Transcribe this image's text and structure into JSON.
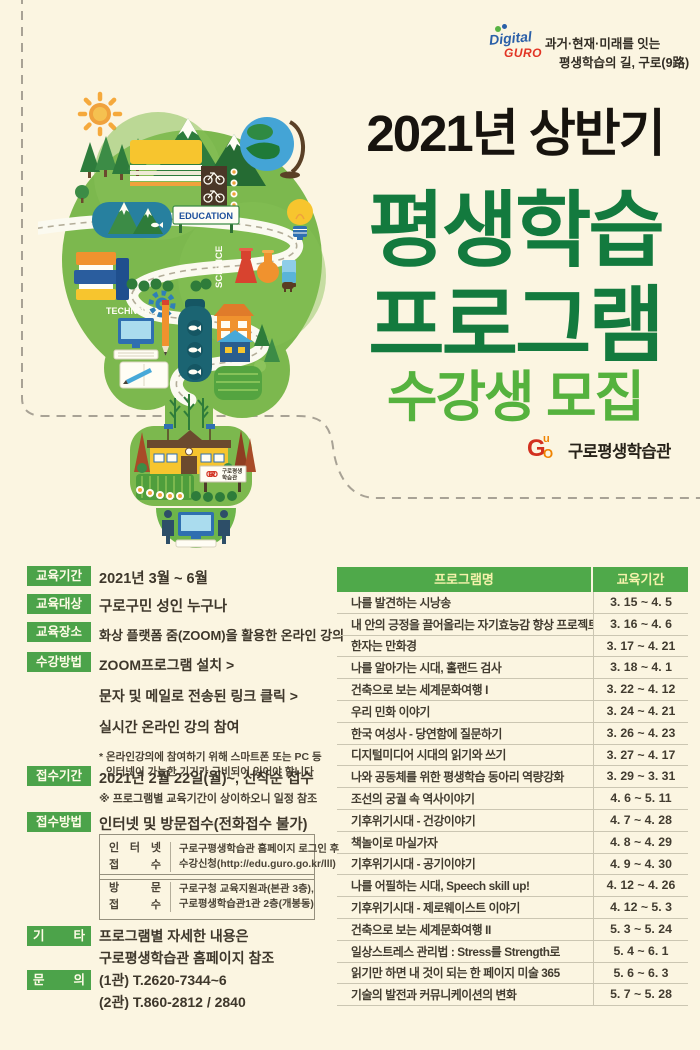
{
  "colors": {
    "background": "#fbf5e1",
    "title_dark_green": "#137a3e",
    "title_light_green": "#55b23e",
    "title_black": "#17130e",
    "label_green": "#4ca34a",
    "table_header_green": "#4fa94a",
    "table_header_text": "#f6f2ac",
    "logo_red": "#d2301f",
    "logo_orange": "#f08300"
  },
  "header": {
    "logo_digital": "Digital",
    "logo_guro": "GURO",
    "tagline_line1": "과거·현재·미래를 잇는",
    "tagline_line2": "평생학습의 길, 구로(9路)"
  },
  "title": {
    "line1": "2021년 상반기",
    "line2": "평생학습",
    "line3": "프로그램",
    "line4": "수강생 모집"
  },
  "org": {
    "mark_g": "G",
    "mark_u": "u",
    "mark_o": "O",
    "name": "구로평생학습관"
  },
  "illustration": {
    "badge_education": "EDUCATION",
    "badge_science": "SCIENCE",
    "badge_technology": "TECHNOLOGY",
    "sign_line1": "구로평생",
    "sign_line2": "학습관",
    "sign_logo": "GURO"
  },
  "sections": {
    "edu_period": {
      "label": "교육기간",
      "value": "2021년 3월 ~ 6월"
    },
    "edu_target": {
      "label": "교육대상",
      "value": "구로구민 성인 누구나"
    },
    "edu_place": {
      "label": "교육장소",
      "value": "화상 플랫폼 줌(ZOOM)을 활용한 온라인 강의"
    },
    "method": {
      "label": "수강방법",
      "steps": [
        "ZOOM프로그램 설치 >",
        "문자 및 메일로 전송된 링크 클릭 >",
        "실시간 온라인 강의 참여"
      ],
      "note_line1": "* 온라인강의에 참여하기 위해 스마트폰 또는 PC 등",
      "note_line2": "인터넷이 가능한 기기가 구비되어 있어야 합니다"
    },
    "apply_period": {
      "label": "접수기간",
      "value": "2021년 2월 22일(월)~, 선착순 접수",
      "note": "※ 프로그램별 교육기간이 상이하오니 일정 참조"
    },
    "apply_method": {
      "label": "접수방법",
      "value": "인터넷 및 방문접수(전화접수 불가)",
      "box1": {
        "label_line1": "인 터 넷",
        "label_line2": "접 수",
        "text_line1": "구로구평생학습관 홈페이지 로그인 후",
        "text_line2": "수강신청(http://edu.guro.go.kr/lll)"
      },
      "box2": {
        "label_line1": "방 문",
        "label_line2": "접 수",
        "text_line1": "구로구청 교육지원과(본관 3층),",
        "text_line2": "구로평생학습관1관 2층(개봉동)"
      }
    },
    "etc": {
      "label": "기 타",
      "line1": "프로그램별 자세한 내용은",
      "line2": "구로평생학습관 홈페이지 참조"
    },
    "contact": {
      "label": "문 의",
      "line1": "(1관) T.2620-7344~6",
      "line2": "(2관) T.860-2812 / 2840"
    }
  },
  "table": {
    "header_name": "프로그램명",
    "header_period": "교육기간",
    "rows": [
      {
        "name": "나를 발견하는 시낭송",
        "period": "3. 15 ~ 4. 5"
      },
      {
        "name": "내 안의 긍정을 끌어올리는 자기효능감 향상 프로젝트",
        "period": "3. 16 ~ 4. 6"
      },
      {
        "name": "한자는 만화경",
        "period": "3. 17 ~ 4. 21"
      },
      {
        "name": "나를 알아가는 시대, 홀랜드 검사",
        "period": "3. 18 ~ 4. 1"
      },
      {
        "name": "건축으로 보는 세계문화여행 I",
        "period": "3. 22 ~ 4. 12"
      },
      {
        "name": "우리 민화 이야기",
        "period": "3. 24 ~ 4. 21"
      },
      {
        "name": "한국 여성사 - 당연함에 질문하기",
        "period": "3. 26 ~ 4. 23"
      },
      {
        "name": "디지털미디어 시대의 읽기와 쓰기",
        "period": "3. 27 ~ 4. 17"
      },
      {
        "name": "나와 공동체를 위한 평생학습 동아리 역량강화",
        "period": "3. 29 ~ 3. 31"
      },
      {
        "name": "조선의 궁궐 속 역사이야기",
        "period": "4. 6 ~ 5. 11"
      },
      {
        "name": "기후위기시대 - 건강이야기",
        "period": "4. 7 ~ 4. 28"
      },
      {
        "name": "책놀이로 마실가자",
        "period": "4. 8 ~ 4. 29"
      },
      {
        "name": "기후위기시대 - 공기이야기",
        "period": "4. 9 ~ 4. 30"
      },
      {
        "name": "나를 어필하는 시대, Speech skill up!",
        "period": "4. 12 ~ 4. 26"
      },
      {
        "name": "기후위기시대 - 제로웨이스트 이야기",
        "period": "4. 12 ~ 5. 3"
      },
      {
        "name": "건축으로 보는 세계문화여행 II",
        "period": "5. 3 ~ 5. 24"
      },
      {
        "name": "일상스트레스 관리법 : Stress를 Strength로",
        "period": "5. 4 ~ 6. 1"
      },
      {
        "name": "읽기만 하면 내 것이 되는 한 페이지 미술 365",
        "period": "5. 6 ~ 6. 3"
      },
      {
        "name": "기술의 발전과 커뮤니케이션의 변화",
        "period": "5. 7 ~ 5. 28"
      }
    ]
  }
}
